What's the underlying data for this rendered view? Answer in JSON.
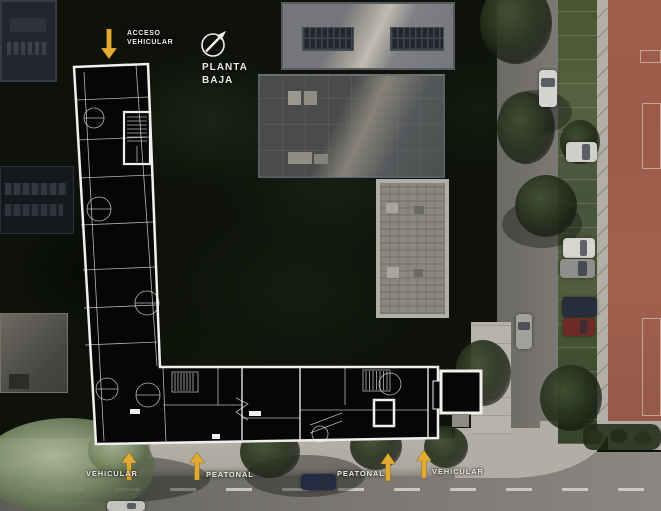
{
  "annotations": {
    "top_access": {
      "lines": [
        "ACCESO",
        "VEHICULAR"
      ],
      "arrow_direction": "down"
    },
    "plan_title": {
      "lines": [
        "PLANTA",
        "BAJA"
      ]
    },
    "bottom": [
      {
        "label": "VEHICULAR",
        "arrow_direction": "up"
      },
      {
        "label": "PEATONAL",
        "arrow_direction": "up"
      },
      {
        "label": "PEATONAL",
        "arrow_direction": "up"
      },
      {
        "label": "VEHICULAR",
        "arrow_direction": "up"
      }
    ]
  },
  "icons": {
    "north": "north-arrow-icon",
    "access": "arrow-down-icon",
    "flow": "arrow-up-icon"
  },
  "colors": {
    "arrow_yellow": "#e3ab32",
    "label_text": "#ecebe7",
    "plan_fill": "#060606",
    "plan_line": "#f0efec",
    "red_building": "#a2614f",
    "bg_vegetation": "#0e120b"
  }
}
